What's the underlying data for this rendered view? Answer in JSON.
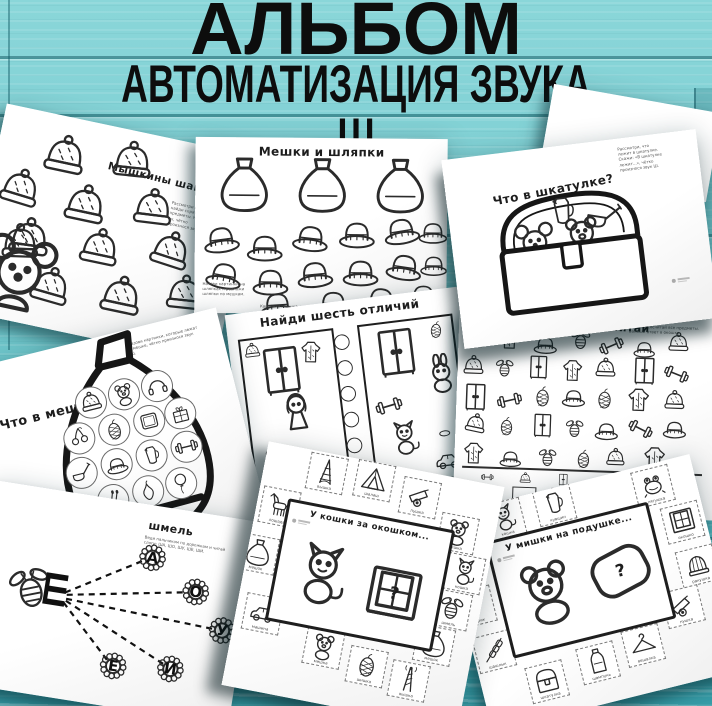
{
  "poster": {
    "title_line1": "АЛЬБОМ",
    "title_line2": "АВТОМАТИЗАЦИЯ ЗВУКА Ш"
  },
  "colors": {
    "background": "#74cbd0",
    "plank_groove": "#125c66",
    "page": "#ffffff",
    "ink": "#2b2b2b",
    "title_text": "#0d0d0d"
  },
  "pages": {
    "myshkiny_shapki": {
      "title": "Мышкины шапки",
      "instruction": "Рассмотри шапки и найди спрятанные предметы. Назови их, чётко произнося звук Ш.",
      "hats": [
        {
          "icon": "beanie",
          "x": 44,
          "y": 16,
          "s": 48
        },
        {
          "icon": "beanie",
          "x": 112,
          "y": 8,
          "s": 46,
          "r": -6
        },
        {
          "icon": "beanie",
          "x": 8,
          "y": 58,
          "s": 46,
          "r": 5
        },
        {
          "icon": "beanie",
          "x": 74,
          "y": 60,
          "s": 48
        },
        {
          "icon": "beanie",
          "x": 142,
          "y": 50,
          "s": 46,
          "r": -5
        },
        {
          "icon": "beanie",
          "x": 26,
          "y": 104,
          "s": 48,
          "r": -4
        },
        {
          "icon": "beanie",
          "x": 98,
          "y": 100,
          "s": 46
        },
        {
          "icon": "beanie",
          "x": 168,
          "y": 88,
          "s": 46,
          "r": 6
        },
        {
          "icon": "beanie",
          "x": 58,
          "y": 148,
          "s": 46,
          "r": 4
        },
        {
          "icon": "beanie",
          "x": 128,
          "y": 142,
          "s": 48
        },
        {
          "icon": "beanie",
          "x": 192,
          "y": 128,
          "s": 44,
          "r": -6
        }
      ],
      "mouse_group": [
        {
          "icon": "mouse",
          "x": 6,
          "y": 124,
          "s": 82
        },
        {
          "icon": "beanie",
          "x": 20,
          "y": 112,
          "s": 44,
          "r": -10
        }
      ]
    },
    "meshki_i_shlyapki": {
      "title": "Мешки и шляпки",
      "instruction": "Назови картинки на шляпках и разложи шляпки по мешкам.",
      "instruction2": "Картинки: мышка, шапка, мишка, шишка, вишня, машина, лягушка, шуба, катушка, пушка, шмель.",
      "sacks": [
        {
          "icon": "sack",
          "x": 20,
          "y": 18,
          "s": 58
        },
        {
          "icon": "sack",
          "x": 98,
          "y": 18,
          "s": 58
        },
        {
          "icon": "sack",
          "x": 176,
          "y": 18,
          "s": 58
        }
      ],
      "hats": [
        {
          "icon": "fedora",
          "x": 6,
          "y": 80,
          "s": 40,
          "r": -8
        },
        {
          "icon": "fedora",
          "x": 50,
          "y": 88,
          "s": 40
        },
        {
          "icon": "fedora",
          "x": 96,
          "y": 78,
          "s": 40,
          "r": 6
        },
        {
          "icon": "fedora",
          "x": 142,
          "y": 74,
          "s": 40
        },
        {
          "icon": "fedora",
          "x": 186,
          "y": 70,
          "s": 40,
          "r": -10
        },
        {
          "icon": "fedora",
          "x": 222,
          "y": 76,
          "s": 32
        },
        {
          "icon": "fedora",
          "x": 10,
          "y": 116,
          "s": 40,
          "r": 10
        },
        {
          "icon": "fedora",
          "x": 56,
          "y": 122,
          "s": 40
        },
        {
          "icon": "fedora",
          "x": 100,
          "y": 114,
          "s": 40,
          "r": -6
        },
        {
          "icon": "fedora",
          "x": 146,
          "y": 112,
          "s": 40
        },
        {
          "icon": "fedora",
          "x": 190,
          "y": 106,
          "s": 40,
          "r": 8
        },
        {
          "icon": "fedora",
          "x": 224,
          "y": 110,
          "s": 30
        },
        {
          "icon": "fedora",
          "x": 64,
          "y": 146,
          "s": 38,
          "r": -4
        },
        {
          "icon": "fedora",
          "x": 120,
          "y": 144,
          "s": 38
        },
        {
          "icon": "fedora",
          "x": 168,
          "y": 140,
          "s": 38,
          "r": 6
        },
        {
          "icon": "fedora",
          "x": 212,
          "y": 138,
          "s": 34
        }
      ]
    },
    "chto_v_shkatulke": {
      "title": "Что в шкатулке?",
      "instruction": "Рассмотри, что лежит в шкатулке. Скажи: «В шкатулке лежит...», чётко произнося звук Ш."
    },
    "chto_v_meshke": {
      "title": "Что в мешке?",
      "instruction": "Назови картинки, которые лежат в мешке, чётко произнося звук Ш.",
      "items": [
        {
          "icon": "beanie",
          "x": 50,
          "y": 46,
          "s": 32,
          "circle": true
        },
        {
          "icon": "bear",
          "x": 84,
          "y": 46,
          "s": 32,
          "circle": true
        },
        {
          "icon": "headphones",
          "x": 118,
          "y": 46,
          "s": 32,
          "circle": true
        },
        {
          "icon": "cherry",
          "x": 30,
          "y": 78,
          "s": 32,
          "circle": true
        },
        {
          "icon": "cone",
          "x": 66,
          "y": 78,
          "s": 32,
          "circle": true
        },
        {
          "icon": "frame",
          "x": 102,
          "y": 78,
          "s": 32,
          "circle": true
        },
        {
          "icon": "gift",
          "x": 134,
          "y": 78,
          "s": 32,
          "circle": true
        },
        {
          "icon": "ladle",
          "x": 24,
          "y": 112,
          "s": 32,
          "circle": true
        },
        {
          "icon": "fedora",
          "x": 60,
          "y": 112,
          "s": 32,
          "circle": true
        },
        {
          "icon": "jug",
          "x": 96,
          "y": 112,
          "s": 32,
          "circle": true
        },
        {
          "icon": "dumbbell",
          "x": 132,
          "y": 112,
          "s": 32,
          "circle": true
        },
        {
          "icon": "matches",
          "x": 48,
          "y": 146,
          "s": 32,
          "circle": true
        },
        {
          "icon": "pear",
          "x": 84,
          "y": 146,
          "s": 32,
          "circle": true
        },
        {
          "icon": "balloon",
          "x": 118,
          "y": 146,
          "s": 32,
          "circle": true
        }
      ]
    },
    "naydi_otlichiya": {
      "title": "Найди шесть отличий",
      "left_items": [
        {
          "icon": "beanie",
          "x": 2,
          "y": 2,
          "s": 18
        },
        {
          "icon": "wardrobe",
          "x": 12,
          "y": 8,
          "s": 52
        },
        {
          "icon": "coat",
          "x": 56,
          "y": 6,
          "s": 26,
          "r": 8
        },
        {
          "icon": "girl",
          "x": 26,
          "y": 54,
          "s": 44
        },
        {
          "icon": "bear",
          "x": 8,
          "y": 110,
          "s": 24
        },
        {
          "icon": "car",
          "x": 56,
          "y": 116,
          "s": 30
        }
      ],
      "right_items": [
        {
          "icon": "wardrobe",
          "x": 8,
          "y": 4,
          "s": 52
        },
        {
          "icon": "cone",
          "x": 66,
          "y": 2,
          "s": 20,
          "r": 10
        },
        {
          "icon": "bunny",
          "x": 56,
          "y": 36,
          "s": 40
        },
        {
          "icon": "dumbbell",
          "x": 6,
          "y": 68,
          "s": 28,
          "r": -10
        },
        {
          "icon": "cat",
          "x": 14,
          "y": 98,
          "s": 36
        },
        {
          "icon": "puck",
          "x": 62,
          "y": 106,
          "s": 20
        },
        {
          "icon": "car",
          "x": 58,
          "y": 128,
          "s": 28
        }
      ],
      "circles": [
        {
          "icon": "circle",
          "x": 0,
          "y": 0,
          "s": 18
        },
        {
          "icon": "circle",
          "x": 0,
          "y": 26,
          "s": 18
        },
        {
          "icon": "circle",
          "x": 0,
          "y": 52,
          "s": 18
        },
        {
          "icon": "circle",
          "x": 0,
          "y": 78,
          "s": 18
        },
        {
          "icon": "circle",
          "x": 0,
          "y": 104,
          "s": 18
        },
        {
          "icon": "circle",
          "x": 0,
          "y": 130,
          "s": 18
        }
      ]
    },
    "naydi_i_poschitay": {
      "title": "Найди и посчитай",
      "instruction": "Найди и сосчитай все предметы. Запиши ответ в окошке.",
      "scatter": [
        {
          "icon": "wardrobe",
          "x": 6,
          "y": 16,
          "s": 22
        },
        {
          "icon": "coat",
          "x": 38,
          "y": 14,
          "s": 26
        },
        {
          "icon": "fedora",
          "x": 74,
          "y": 18,
          "s": 26
        },
        {
          "icon": "bee",
          "x": 110,
          "y": 14,
          "s": 24
        },
        {
          "icon": "dumbbell",
          "x": 140,
          "y": 18,
          "s": 26,
          "r": -25
        },
        {
          "icon": "fedora",
          "x": 174,
          "y": 20,
          "s": 24
        },
        {
          "icon": "beanie",
          "x": 208,
          "y": 14,
          "s": 24
        },
        {
          "icon": "beanie",
          "x": 4,
          "y": 44,
          "s": 24
        },
        {
          "icon": "bee",
          "x": 36,
          "y": 46,
          "s": 22
        },
        {
          "icon": "wardrobe",
          "x": 68,
          "y": 42,
          "s": 26
        },
        {
          "icon": "coat",
          "x": 102,
          "y": 44,
          "s": 26
        },
        {
          "icon": "beanie",
          "x": 136,
          "y": 42,
          "s": 24
        },
        {
          "icon": "wardrobe",
          "x": 172,
          "y": 40,
          "s": 30
        },
        {
          "icon": "dumbbell",
          "x": 206,
          "y": 44,
          "s": 26,
          "r": 20
        },
        {
          "icon": "wardrobe",
          "x": 4,
          "y": 72,
          "s": 30
        },
        {
          "icon": "dumbbell",
          "x": 40,
          "y": 76,
          "s": 26,
          "r": -15
        },
        {
          "icon": "cone",
          "x": 74,
          "y": 72,
          "s": 24
        },
        {
          "icon": "fedora",
          "x": 104,
          "y": 70,
          "s": 26
        },
        {
          "icon": "cone",
          "x": 136,
          "y": 72,
          "s": 24
        },
        {
          "icon": "coat",
          "x": 168,
          "y": 70,
          "s": 28
        },
        {
          "icon": "beanie",
          "x": 206,
          "y": 72,
          "s": 24
        },
        {
          "icon": "beanie",
          "x": 8,
          "y": 102,
          "s": 24,
          "r": 10
        },
        {
          "icon": "cone",
          "x": 40,
          "y": 104,
          "s": 22
        },
        {
          "icon": "wardrobe",
          "x": 74,
          "y": 100,
          "s": 26
        },
        {
          "icon": "bee",
          "x": 108,
          "y": 104,
          "s": 22
        },
        {
          "icon": "fedora",
          "x": 138,
          "y": 102,
          "s": 26
        },
        {
          "icon": "dumbbell",
          "x": 172,
          "y": 100,
          "s": 26,
          "r": 25
        },
        {
          "icon": "fedora",
          "x": 206,
          "y": 98,
          "s": 26
        },
        {
          "icon": "coat",
          "x": 6,
          "y": 130,
          "s": 26
        },
        {
          "icon": "fedora",
          "x": 44,
          "y": 134,
          "s": 24
        },
        {
          "icon": "bee",
          "x": 82,
          "y": 134,
          "s": 22
        },
        {
          "icon": "cone",
          "x": 118,
          "y": 134,
          "s": 22
        },
        {
          "icon": "beanie",
          "x": 150,
          "y": 132,
          "s": 22
        },
        {
          "icon": "coat",
          "x": 186,
          "y": 128,
          "s": 28
        }
      ],
      "count_row": [
        {
          "icon": "dumbbell",
          "cell": true
        },
        {
          "icon": "beanie",
          "cell": true
        },
        {
          "icon": "wardrobe",
          "cell": true
        },
        {
          "icon": "fedora",
          "cell": true
        },
        {
          "icon": "coat",
          "cell": true
        },
        {
          "icon": "bee",
          "cell": true
        }
      ]
    },
    "shmel": {
      "title": "шмель",
      "instruction": "Веди пальчиком по дорожкам и читай слоги: ША, ШО, ШУ, ШЕ, ШИ.",
      "letter": "Ш",
      "bee_items": [
        {
          "icon": "bee",
          "x": 26,
          "y": 76,
          "s": 50,
          "r": -20
        }
      ],
      "flowers": [
        {
          "icon": "flower",
          "x": 150,
          "y": 35,
          "s": 34,
          "letter": "А"
        },
        {
          "icon": "flower",
          "x": 198,
          "y": 62,
          "s": 34,
          "letter": "О"
        },
        {
          "icon": "flower",
          "x": 230,
          "y": 96,
          "s": 34,
          "letter": "У"
        },
        {
          "icon": "flower",
          "x": 128,
          "y": 148,
          "s": 34,
          "letter": "Е"
        },
        {
          "icon": "flower",
          "x": 185,
          "y": 142,
          "s": 34,
          "letter": "И"
        }
      ]
    },
    "u_koshki": {
      "title": "У кошки за окошком...",
      "question": "?",
      "cards": [
        {
          "icon": "eiffel",
          "x": 44,
          "y": 2,
          "label": "вышка",
          "card": true
        },
        {
          "icon": "hut",
          "x": 92,
          "y": 0,
          "label": "шалаш",
          "card": true
        },
        {
          "icon": "cannon",
          "x": 140,
          "y": 8,
          "label": "пушка",
          "card": true
        },
        {
          "icon": "horse",
          "x": 4,
          "y": 44,
          "label": "лошадь",
          "card": true
        },
        {
          "icon": "sack",
          "x": -8,
          "y": 94,
          "label": "мешок",
          "card": true
        },
        {
          "icon": "car",
          "x": 8,
          "y": 152,
          "label": "машина",
          "card": true
        },
        {
          "icon": "bear",
          "x": 184,
          "y": 36,
          "label": "мишка",
          "card": true
        },
        {
          "icon": "cat",
          "x": 198,
          "y": 74,
          "label": "кошка",
          "card": true
        },
        {
          "icon": "bee",
          "x": 192,
          "y": 112,
          "label": "шмель",
          "card": true
        },
        {
          "icon": "sack",
          "x": 182,
          "y": 150,
          "label": "мешок",
          "card": true
        },
        {
          "icon": "tower",
          "x": 164,
          "y": 190,
          "label": "вышка",
          "card": true
        },
        {
          "icon": "cone",
          "x": 120,
          "y": 184,
          "label": "шишка",
          "card": true
        },
        {
          "icon": "bear",
          "x": 74,
          "y": 174,
          "label": "мишка",
          "card": true
        }
      ]
    },
    "u_mishki": {
      "title": "У мишки на подушке...",
      "question": "?",
      "cards": [
        {
          "icon": "cat",
          "x": 44,
          "y": 0,
          "label": "кошка",
          "card": true
        },
        {
          "icon": "jug",
          "x": 96,
          "y": -2,
          "label": "кувшин",
          "card": true
        },
        {
          "icon": "frog",
          "x": 196,
          "y": 4,
          "label": "лягушка",
          "card": true
        },
        {
          "icon": "window",
          "x": 216,
          "y": 46,
          "label": "окошко",
          "card": true
        },
        {
          "icon": "shell",
          "x": 220,
          "y": 92,
          "label": "ракушка",
          "card": true
        },
        {
          "icon": "cannon",
          "x": 196,
          "y": 128,
          "label": "пушка",
          "card": true
        },
        {
          "icon": "hanger",
          "x": 148,
          "y": 156,
          "label": "вешалка",
          "card": true
        },
        {
          "icon": "bottle",
          "x": 100,
          "y": 162,
          "label": "шампунь",
          "card": true
        },
        {
          "icon": "chest",
          "x": 46,
          "y": 168,
          "label": "шкатулка",
          "card": true
        },
        {
          "icon": "kebab",
          "x": 2,
          "y": 126,
          "label": "шашлык",
          "card": true
        },
        {
          "icon": "balloon",
          "x": -6,
          "y": 78,
          "label": "шарик",
          "card": true
        }
      ]
    }
  }
}
